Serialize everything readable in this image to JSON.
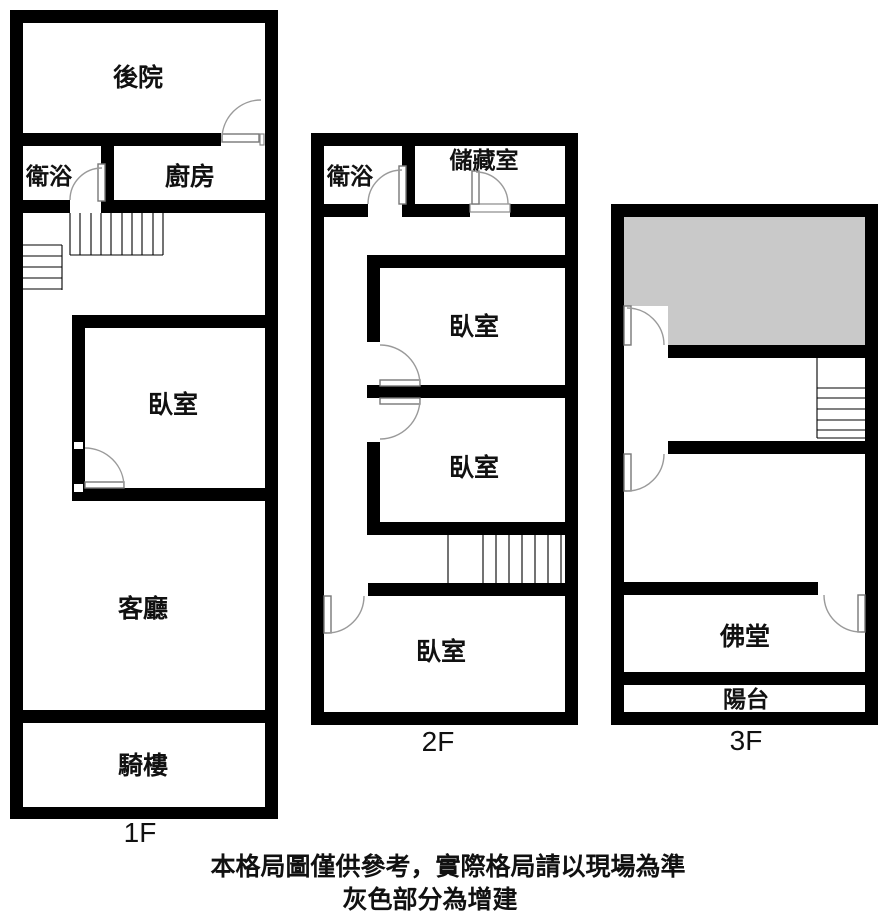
{
  "floors": {
    "f1": {
      "label": "1F",
      "rooms": {
        "backyard": "後院",
        "bathroom": "衛浴",
        "kitchen": "廚房",
        "bedroom": "臥室",
        "living_room": "客廳",
        "arcade": "騎樓"
      }
    },
    "f2": {
      "label": "2F",
      "rooms": {
        "bathroom": "衛浴",
        "storage": "儲藏室",
        "bedroom_top": "臥室",
        "bedroom_middle": "臥室",
        "bedroom_bottom": "臥室"
      }
    },
    "f3": {
      "label": "3F",
      "rooms": {
        "buddhist_hall": "佛堂",
        "balcony": "陽台"
      }
    },
    "count": 3
  },
  "disclaimer": {
    "line1": "本格局圖僅供參考，實際格局請以現場為準",
    "line2": "灰色部分為增建"
  },
  "colors": {
    "wall": "#000000",
    "addition_fill": "#c9c9c9",
    "background": "#ffffff",
    "door_stroke": "#9a9a9a"
  },
  "symbols": {
    "door": "quarter-arc-swing",
    "stairs": "parallel-tread-lines",
    "addition_area": "gray-filled-region"
  }
}
